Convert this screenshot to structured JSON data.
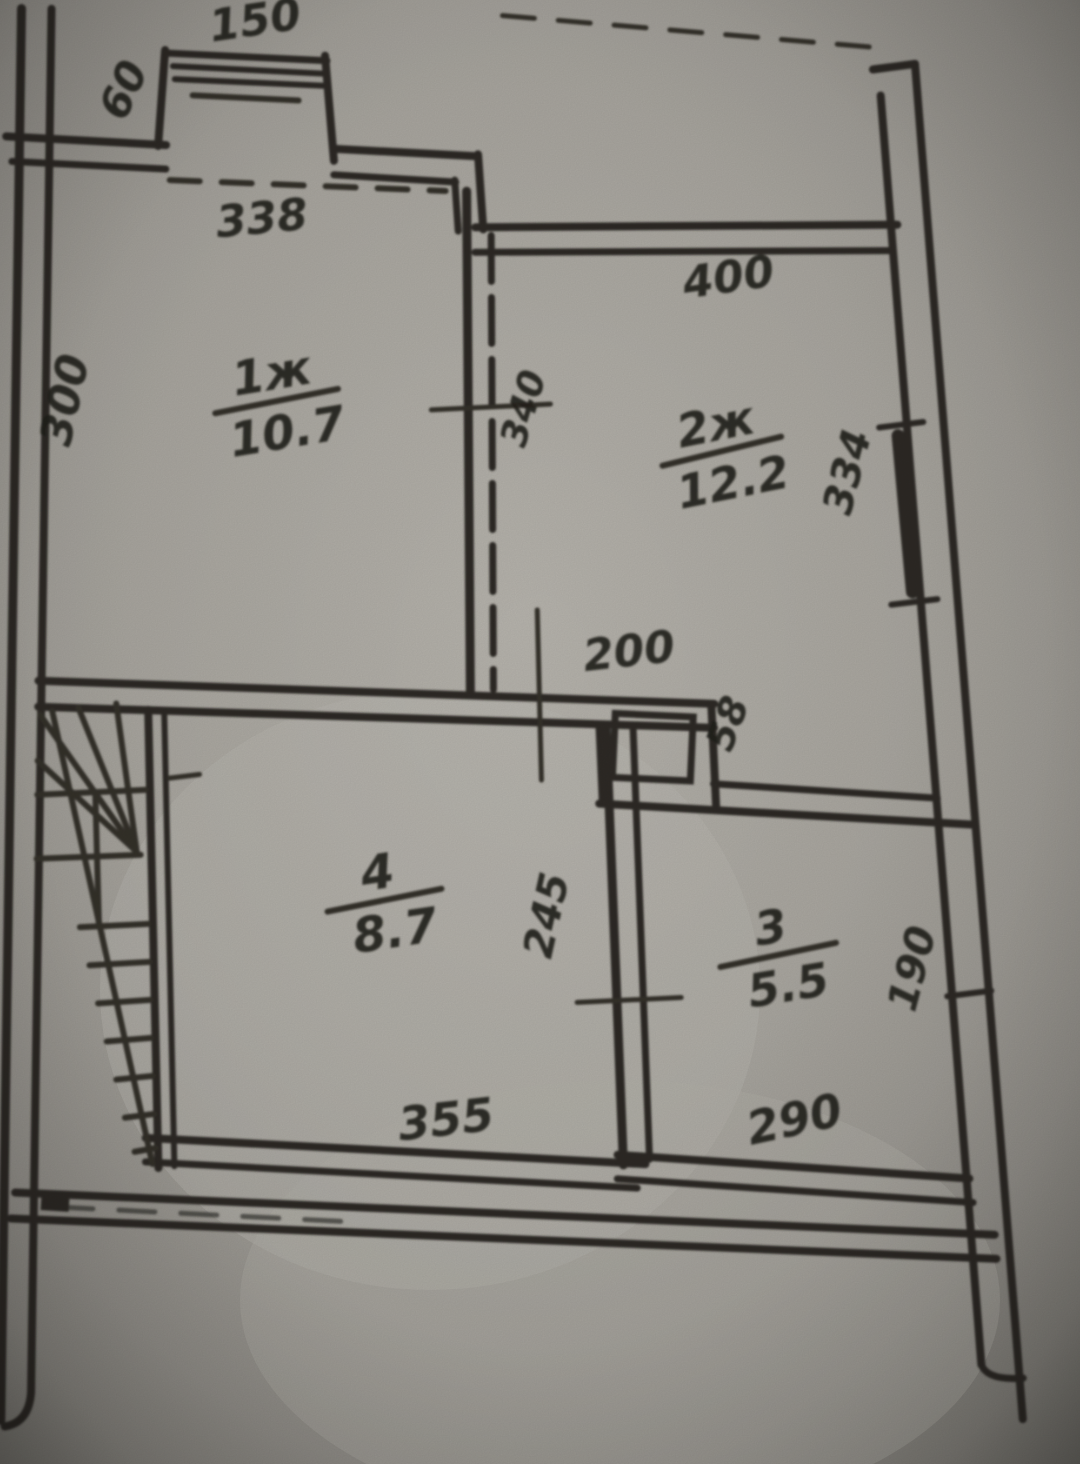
{
  "document": {
    "kind": "hand-drawn apartment floor plan (photo of paper blueprint)",
    "paper_color": "#b2afa8",
    "ink_color": "#2e2c27"
  },
  "rooms": [
    {
      "number": "1ж",
      "area": "10.7"
    },
    {
      "number": "2ж",
      "area": "12.2"
    },
    {
      "number": "3",
      "area": "5.5"
    },
    {
      "number": "4",
      "area": "8.7"
    }
  ],
  "dims": {
    "balcony_width": "150",
    "balcony_side": "60",
    "room1_top": "338",
    "room1_left": "300",
    "room2_top": "400",
    "wall_segment": "340",
    "room2_right": "334",
    "opening": "200",
    "shaft": "58",
    "corridor": "245",
    "room3_right": "190",
    "room4_bottom": "355",
    "room3_bottom": "290"
  }
}
